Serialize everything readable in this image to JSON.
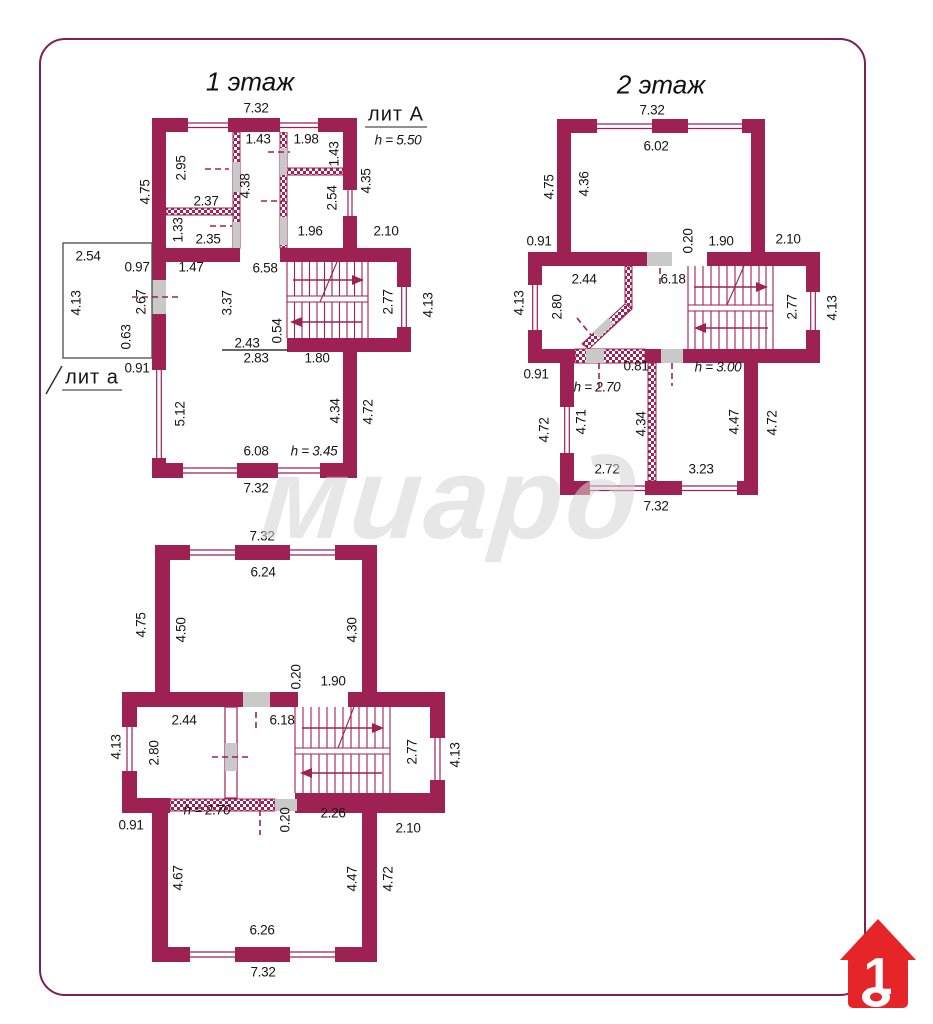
{
  "watermark": "миард",
  "logo": {
    "number": "1"
  },
  "plans": [
    {
      "id": "floor1",
      "title": "1 этаж",
      "labels": [
        {
          "t": "7.32",
          "x": 256,
          "y": 108
        },
        {
          "t": "лит А",
          "x": 396,
          "y": 116,
          "cls": "big u"
        },
        {
          "t": "h = 5.50",
          "x": 398,
          "y": 140,
          "i": 1
        },
        {
          "t": "1.43",
          "x": 258,
          "y": 139
        },
        {
          "t": "1.98",
          "x": 306,
          "y": 139
        },
        {
          "t": "1.43",
          "x": 334,
          "y": 154,
          "r": 1
        },
        {
          "t": "4.35",
          "x": 366,
          "y": 181,
          "r": 1
        },
        {
          "t": "2.95",
          "x": 181,
          "y": 168,
          "r": 1
        },
        {
          "t": "2.37",
          "x": 206,
          "y": 201
        },
        {
          "t": "4.38",
          "x": 245,
          "y": 186,
          "r": 1
        },
        {
          "t": "2.54",
          "x": 332,
          "y": 198,
          "r": 1
        },
        {
          "t": "1.33",
          "x": 178,
          "y": 230,
          "r": 1
        },
        {
          "t": "2.35",
          "x": 208,
          "y": 239
        },
        {
          "t": "1.96",
          "x": 310,
          "y": 231
        },
        {
          "t": "2.10",
          "x": 386,
          "y": 231
        },
        {
          "t": "4.75",
          "x": 145,
          "y": 192,
          "r": 1
        },
        {
          "t": "2.54",
          "x": 88,
          "y": 256
        },
        {
          "t": "4.13",
          "x": 76,
          "y": 303,
          "r": 1
        },
        {
          "t": "0.97",
          "x": 137,
          "y": 267
        },
        {
          "t": "2.67",
          "x": 141,
          "y": 302,
          "r": 1
        },
        {
          "t": "0.63",
          "x": 126,
          "y": 337,
          "r": 1
        },
        {
          "t": "0.91",
          "x": 137,
          "y": 368
        },
        {
          "t": "лит а",
          "x": 92,
          "y": 379,
          "cls": "big u"
        },
        {
          "t": "1.47",
          "x": 191,
          "y": 267
        },
        {
          "t": "6.58",
          "x": 265,
          "y": 268
        },
        {
          "t": "3.37",
          "x": 227,
          "y": 303,
          "r": 1
        },
        {
          "t": "0.54",
          "x": 277,
          "y": 331,
          "r": 1
        },
        {
          "t": "2.43",
          "x": 247,
          "y": 343
        },
        {
          "t": "2.83",
          "x": 256,
          "y": 358
        },
        {
          "t": "1.80",
          "x": 317,
          "y": 358
        },
        {
          "t": "2.77",
          "x": 388,
          "y": 302,
          "r": 1
        },
        {
          "t": "4.13",
          "x": 428,
          "y": 305,
          "r": 1
        },
        {
          "t": "5.12",
          "x": 180,
          "y": 414,
          "r": 1
        },
        {
          "t": "6.08",
          "x": 256,
          "y": 451
        },
        {
          "t": "h = 3.45",
          "x": 314,
          "y": 451,
          "i": 1
        },
        {
          "t": "4.34",
          "x": 335,
          "y": 411,
          "r": 1
        },
        {
          "t": "4.72",
          "x": 368,
          "y": 412,
          "r": 1
        },
        {
          "t": "7.32",
          "x": 256,
          "y": 488
        }
      ]
    },
    {
      "id": "floor2",
      "title": "2 этаж",
      "labels": [
        {
          "t": "7.32",
          "x": 652,
          "y": 110
        },
        {
          "t": "6.02",
          "x": 656,
          "y": 146
        },
        {
          "t": "4.75",
          "x": 549,
          "y": 187,
          "r": 1
        },
        {
          "t": "4.36",
          "x": 584,
          "y": 184,
          "r": 1
        },
        {
          "t": "0.91",
          "x": 539,
          "y": 241
        },
        {
          "t": "0.20",
          "x": 688,
          "y": 241,
          "r": 1
        },
        {
          "t": "1.90",
          "x": 721,
          "y": 241
        },
        {
          "t": "2.10",
          "x": 788,
          "y": 239
        },
        {
          "t": "2.44",
          "x": 584,
          "y": 279
        },
        {
          "t": "2.80",
          "x": 557,
          "y": 307,
          "r": 1
        },
        {
          "t": "4.13",
          "x": 519,
          "y": 303,
          "r": 1
        },
        {
          "t": "6.18",
          "x": 673,
          "y": 279
        },
        {
          "t": "2.77",
          "x": 792,
          "y": 307,
          "r": 1
        },
        {
          "t": "4.13",
          "x": 832,
          "y": 308,
          "r": 1
        },
        {
          "t": "0.81",
          "x": 636,
          "y": 366
        },
        {
          "t": "h = 2.70",
          "x": 597,
          "y": 387,
          "i": 1
        },
        {
          "t": "h = 3.00",
          "x": 718,
          "y": 367,
          "i": 1
        },
        {
          "t": "0.91",
          "x": 536,
          "y": 374
        },
        {
          "t": "4.72",
          "x": 544,
          "y": 430,
          "r": 1
        },
        {
          "t": "4.71",
          "x": 581,
          "y": 422,
          "r": 1
        },
        {
          "t": "4.34",
          "x": 641,
          "y": 424,
          "r": 1
        },
        {
          "t": "4.47",
          "x": 734,
          "y": 422,
          "r": 1
        },
        {
          "t": "4.72",
          "x": 772,
          "y": 423,
          "r": 1
        },
        {
          "t": "2.72",
          "x": 607,
          "y": 469
        },
        {
          "t": "3.23",
          "x": 701,
          "y": 469
        },
        {
          "t": "7.32",
          "x": 656,
          "y": 506
        }
      ]
    },
    {
      "id": "floor3",
      "labels": [
        {
          "t": "7.32",
          "x": 262,
          "y": 536
        },
        {
          "t": "6.24",
          "x": 263,
          "y": 572
        },
        {
          "t": "4.75",
          "x": 141,
          "y": 625,
          "r": 1
        },
        {
          "t": "4.50",
          "x": 181,
          "y": 630,
          "r": 1
        },
        {
          "t": "4.30",
          "x": 352,
          "y": 630,
          "r": 1
        },
        {
          "t": "0.20",
          "x": 296,
          "y": 677,
          "r": 1
        },
        {
          "t": "1.90",
          "x": 333,
          "y": 681
        },
        {
          "t": "2.44",
          "x": 184,
          "y": 720
        },
        {
          "t": "2.80",
          "x": 154,
          "y": 753,
          "r": 1
        },
        {
          "t": "4.13",
          "x": 116,
          "y": 747,
          "r": 1
        },
        {
          "t": "6.18",
          "x": 282,
          "y": 720
        },
        {
          "t": "2.77",
          "x": 412,
          "y": 752,
          "r": 1
        },
        {
          "t": "4.13",
          "x": 455,
          "y": 755,
          "r": 1
        },
        {
          "t": "h = 2.70",
          "x": 207,
          "y": 810,
          "i": 1
        },
        {
          "t": "0.20",
          "x": 285,
          "y": 820,
          "r": 1
        },
        {
          "t": "2.26",
          "x": 333,
          "y": 813
        },
        {
          "t": "0.91",
          "x": 131,
          "y": 825
        },
        {
          "t": "2.10",
          "x": 408,
          "y": 828
        },
        {
          "t": "4.67",
          "x": 178,
          "y": 878,
          "r": 1
        },
        {
          "t": "4.47",
          "x": 352,
          "y": 879,
          "r": 1
        },
        {
          "t": "4.72",
          "x": 388,
          "y": 879,
          "r": 1
        },
        {
          "t": "6.26",
          "x": 262,
          "y": 930
        },
        {
          "t": "7.32",
          "x": 263,
          "y": 972
        }
      ]
    }
  ]
}
